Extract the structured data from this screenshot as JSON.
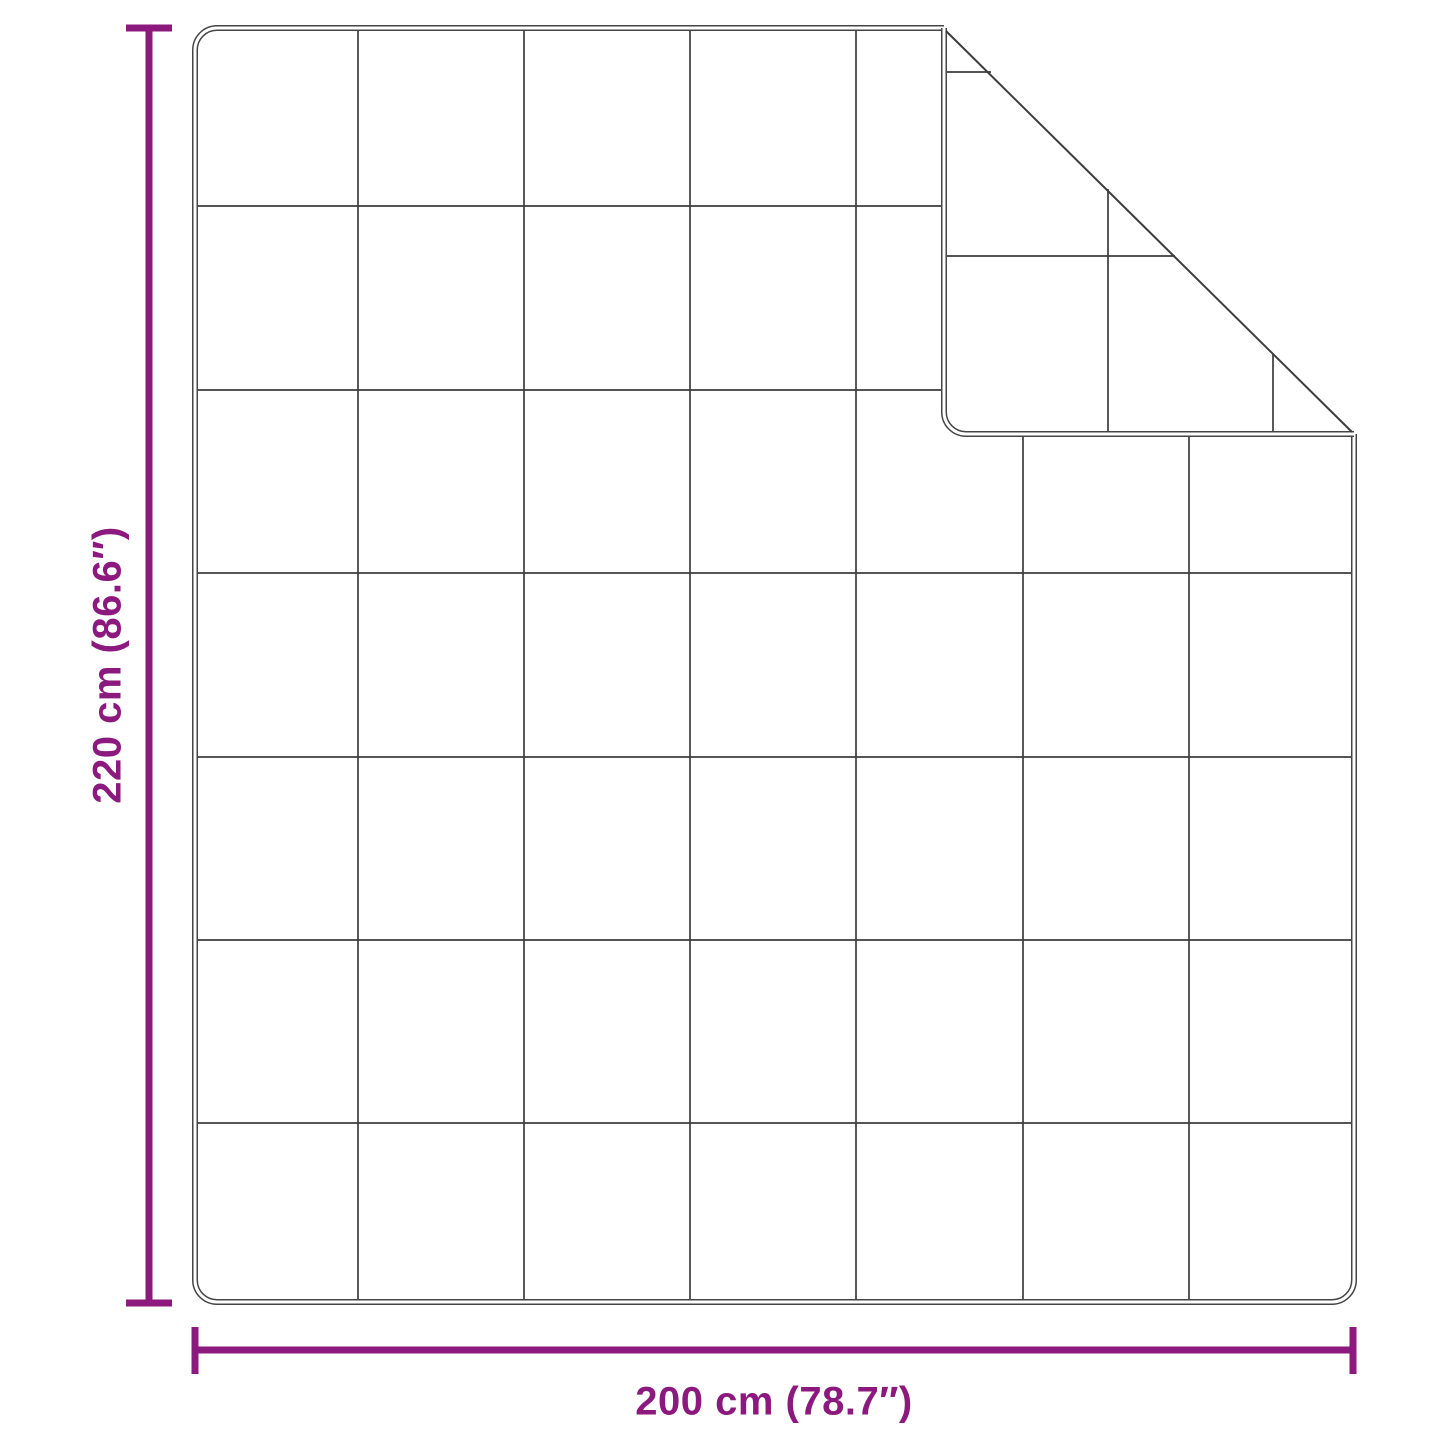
{
  "figure": {
    "background_color": "#ffffff",
    "accent_color": "#8c1a7e",
    "outline_color": "#454545",
    "stitch_color": "#3c3c3c",
    "height_dimension": {
      "label": "220 cm (86.6″)",
      "value_cm": 220,
      "value_inches": 86.6
    },
    "width_dimension": {
      "label": "200 cm (78.7″)",
      "value_cm": 200,
      "value_inches": 78.7
    },
    "quilt_grid": {
      "columns": 7,
      "rows": 7
    },
    "folded_corner": "top-right"
  }
}
